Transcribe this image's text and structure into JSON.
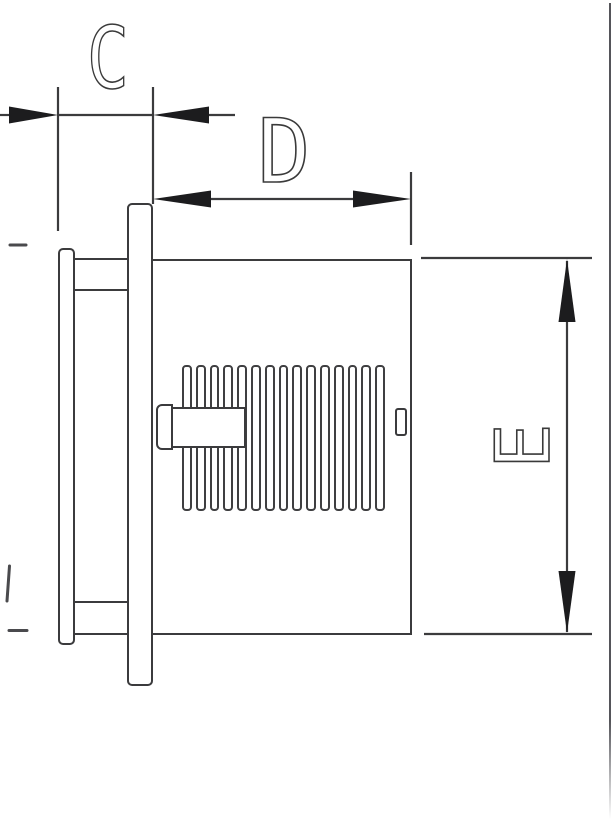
{
  "drawing": {
    "dimension_labels": {
      "c": "C",
      "d": "D",
      "e": "E"
    }
  },
  "colors": {
    "line": "#3b3b3d",
    "arrowhead": "#1c1c1e",
    "label_text": "#3a3a3a",
    "page_border": "#55555a",
    "background": "#ffffff"
  }
}
